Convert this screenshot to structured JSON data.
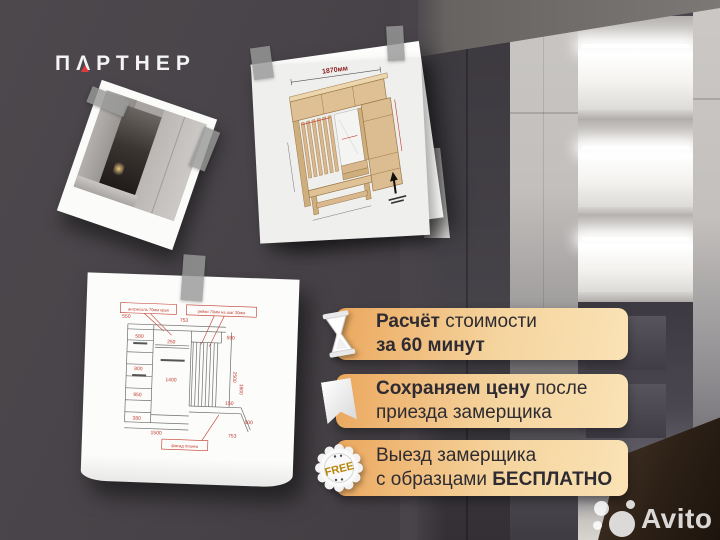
{
  "brand": {
    "logo_pre": "П",
    "logo_a": "Λ",
    "logo_post": "РТНЕР",
    "accent_color": "#e2383f"
  },
  "badges": [
    {
      "icon": "hourglass-icon",
      "line1_bold": "Расчёт",
      "line1_regular": " стоимости",
      "line2_bold": "за 60 минут"
    },
    {
      "icon": "bookmark-icon",
      "line1_bold": "Сохраняем цену",
      "line1_regular": " после",
      "line2_regular": "приезда замерщика"
    },
    {
      "icon": "free-seal-icon",
      "line1_regular": "Выезд замерщика",
      "line2_regular": "с образцами ",
      "line2_bold": "БЕСПЛАТНО",
      "seal_text": "FREE"
    }
  ],
  "drawing3d": {
    "width_label": "1870мм"
  },
  "sketch": {
    "labels": {
      "top_left": "антресоль 70мм края",
      "top_right": "рейки 70мм на шаг 30мм",
      "bottom": "фасад планка"
    },
    "dims": [
      "550",
      "753",
      "580",
      "800",
      "950",
      "380",
      "250",
      "1400",
      "590",
      "2500",
      "1600",
      "150",
      "500",
      "1500",
      "753"
    ]
  },
  "watermark": {
    "text": "Avito"
  },
  "colors": {
    "background_dark": "#48444a",
    "badge_gradient_start": "#eba75d",
    "badge_gradient_end": "#fae3b6",
    "badge_text": "#2e2c32",
    "logo_accent": "#e2383f",
    "seal_free_gold": "#b8860b"
  }
}
